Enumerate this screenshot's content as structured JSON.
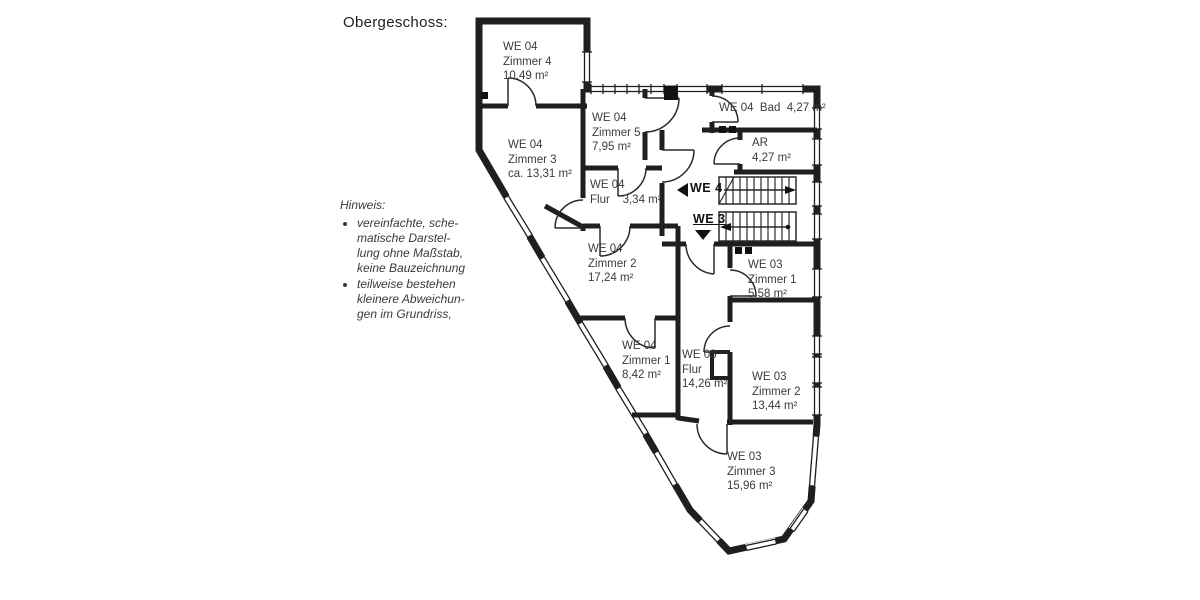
{
  "page": {
    "title": "Obergeschoss:"
  },
  "note": {
    "heading": "Hinweis:",
    "bullets": [
      "vereinfachte, sche-\nmatische Darstel-\nlung ohne Maßstab,\nkeine Bauzeichnung",
      "teilweise bestehen\nkleinere Abweichun-\ngen im Grundriss,"
    ]
  },
  "floorplan": {
    "markers": {
      "we4": "WE 4",
      "we3": "WE 3"
    },
    "colors": {
      "wall": "#1f1f1f",
      "text": "#3b3b3b"
    },
    "rooms": [
      {
        "id": "we04-zimmer4",
        "label": "WE 04\nZimmer 4\n10.49 m²"
      },
      {
        "id": "we04-zimmer3",
        "label": "WE 04\nZimmer 3\nca. 13,31 m²"
      },
      {
        "id": "we04-zimmer5",
        "label": "WE 04\nZimmer 5\n7,95 m²"
      },
      {
        "id": "we04-flur",
        "label": "WE 04\nFlur    3,34 m²"
      },
      {
        "id": "we04-bad",
        "label": "WE 04  Bad  4,27 m²"
      },
      {
        "id": "abstellraum",
        "label": "AR\n4,27 m²"
      },
      {
        "id": "we04-zimmer2",
        "label": "WE 04\nZimmer 2\n17,24 m²"
      },
      {
        "id": "we04-zimmer1",
        "label": "WE 04\nZimmer 1\n8,42 m²"
      },
      {
        "id": "we03-flur",
        "label": "WE 03\nFlur\n14,26 m²"
      },
      {
        "id": "we03-zimmer1",
        "label": "WE 03\nZimmer 1\n5,58 m²"
      },
      {
        "id": "we03-zimmer2",
        "label": "WE 03\nZimmer 2\n13,44 m²"
      },
      {
        "id": "we03-zimmer3",
        "label": "WE 03\nZimmer 3\n15,96 m²"
      }
    ]
  }
}
